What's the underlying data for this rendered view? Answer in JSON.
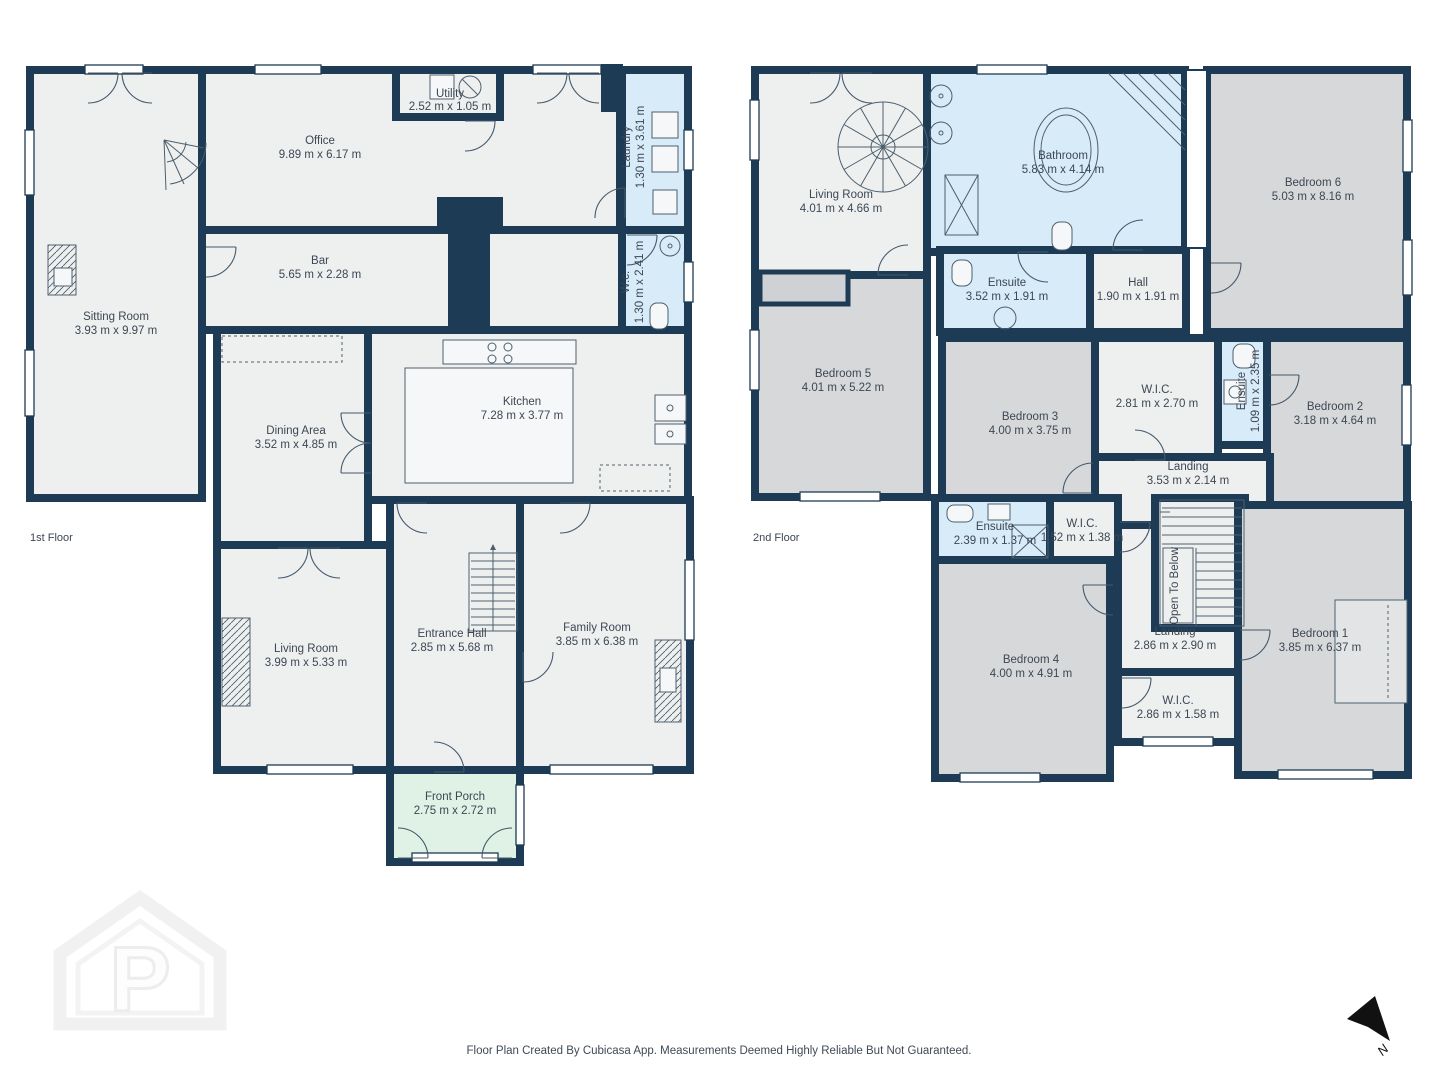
{
  "colors": {
    "wall": "#1d3b54",
    "floor": "#eef0f0",
    "bedroom": "#d6d8da",
    "wet": "#d8ebf9",
    "porch": "#dff2e5",
    "text": "#3c4753"
  },
  "footer": {
    "text": "Floor Plan Created By Cubicasa App. Measurements Deemed Highly Reliable But Not Guaranteed."
  },
  "watermark": {
    "letter": "P"
  },
  "north": {
    "label": "N"
  },
  "floors": [
    {
      "label": "1st Floor",
      "rooms": [
        {
          "name": "Sitting Room",
          "dims": "3.93 m x 9.97 m"
        },
        {
          "name": "Office",
          "dims": "9.89 m x 6.17 m"
        },
        {
          "name": "Utility",
          "dims": "2.52 m x 1.05 m"
        },
        {
          "name": "Laundry",
          "dims": "1.30 m x 3.61 m"
        },
        {
          "name": "Bar",
          "dims": "5.65 m x 2.28 m"
        },
        {
          "name": "W.c.",
          "dims": "1.30 m x 2.41 m"
        },
        {
          "name": "Kitchen",
          "dims": "7.28 m x 3.77 m"
        },
        {
          "name": "Dining Area",
          "dims": "3.52 m x 4.85 m"
        },
        {
          "name": "Living Room",
          "dims": "3.99 m x 5.33 m"
        },
        {
          "name": "Entrance Hall",
          "dims": "2.85 m x 5.68 m"
        },
        {
          "name": "Family Room",
          "dims": "3.85 m x 6.38 m"
        },
        {
          "name": "Front Porch",
          "dims": "2.75 m x 2.72 m"
        }
      ]
    },
    {
      "label": "2nd Floor",
      "rooms": [
        {
          "name": "Living Room",
          "dims": "4.01 m x 4.66 m"
        },
        {
          "name": "Bathroom",
          "dims": "5.83 m x 4.14 m"
        },
        {
          "name": "Bedroom 6",
          "dims": "5.03 m x 8.16 m"
        },
        {
          "name": "Ensuite",
          "dims": "3.52 m x 1.91 m"
        },
        {
          "name": "Hall",
          "dims": "1.90 m x 1.91 m"
        },
        {
          "name": "Bedroom 5",
          "dims": "4.01 m x 5.22 m"
        },
        {
          "name": "Bedroom 3",
          "dims": "4.00 m x 3.75 m"
        },
        {
          "name": "W.I.C.",
          "dims": "2.81 m x 2.70 m"
        },
        {
          "name": "Ensuite",
          "dims": "1.09 m x 2.35 m"
        },
        {
          "name": "Bedroom 2",
          "dims": "3.18 m x 4.64 m"
        },
        {
          "name": "Landing",
          "dims": "3.53 m x 2.14 m"
        },
        {
          "name": "Ensuite",
          "dims": "2.39 m x 1.37 m"
        },
        {
          "name": "W.I.C.",
          "dims": "1.52 m x 1.38 m"
        },
        {
          "name": "Open To Below",
          "dims": ""
        },
        {
          "name": "Bedroom 4",
          "dims": "4.00 m x 4.91 m"
        },
        {
          "name": "Landing",
          "dims": "2.86 m x 2.90 m"
        },
        {
          "name": "Bedroom 1",
          "dims": "3.85 m x 6.37 m"
        },
        {
          "name": "W.I.C.",
          "dims": "2.86 m x 1.58 m"
        }
      ]
    }
  ]
}
